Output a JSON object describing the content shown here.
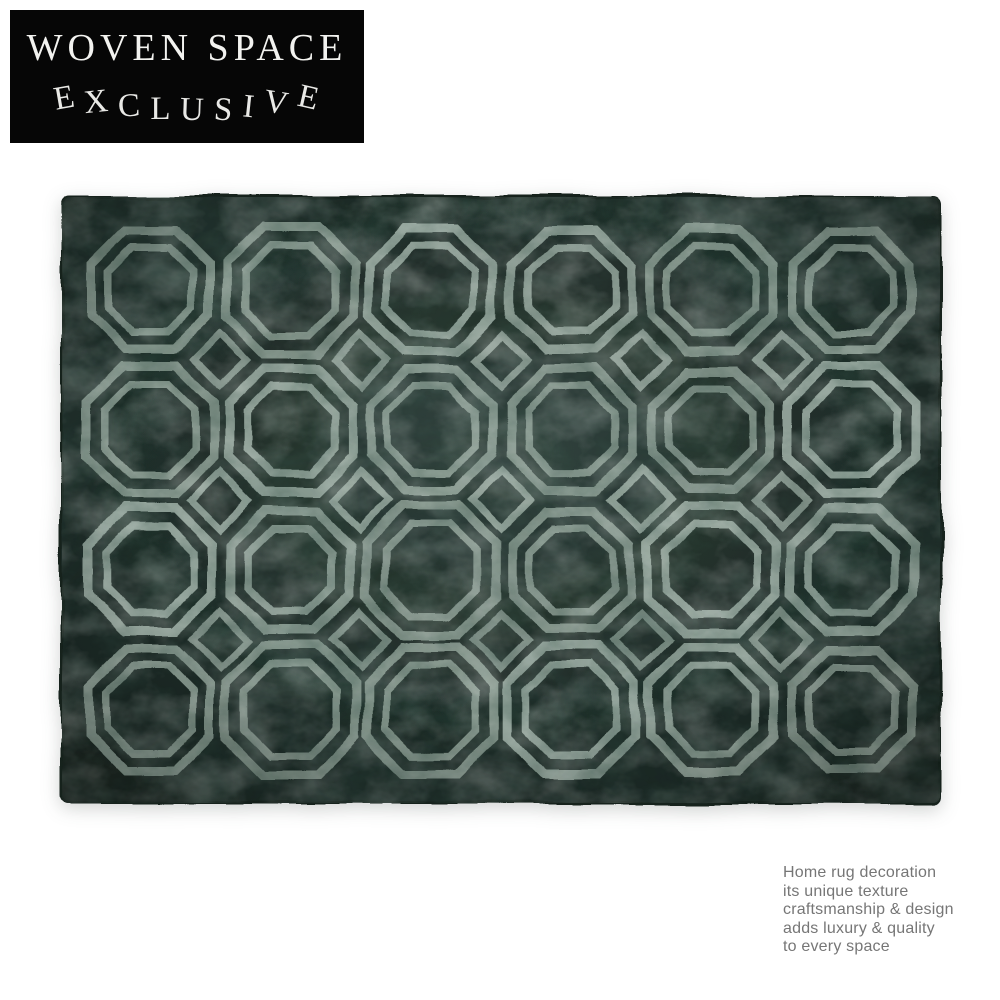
{
  "brand": {
    "line1": "WOVEN SPACE",
    "line2": "EXCLUSIVE",
    "banner_bg": "#060606",
    "text_color": "#f3f3f0"
  },
  "product": {
    "name": "octagon-pattern-rug",
    "pattern": {
      "rows": 4,
      "cols": 6,
      "motif": "double-outline octagons with diamond accents"
    },
    "colors": {
      "base": "#253530",
      "base_edge": "#1a2622",
      "line": "#96a89e",
      "noise_light": "#bac8bf",
      "noise_dark": "#0c1714"
    }
  },
  "description": {
    "text_color": "#767676",
    "lines": [
      "Home rug decoration",
      "its unique texture",
      "craftsmanship & design",
      "adds luxury & quality",
      "to every space"
    ]
  }
}
